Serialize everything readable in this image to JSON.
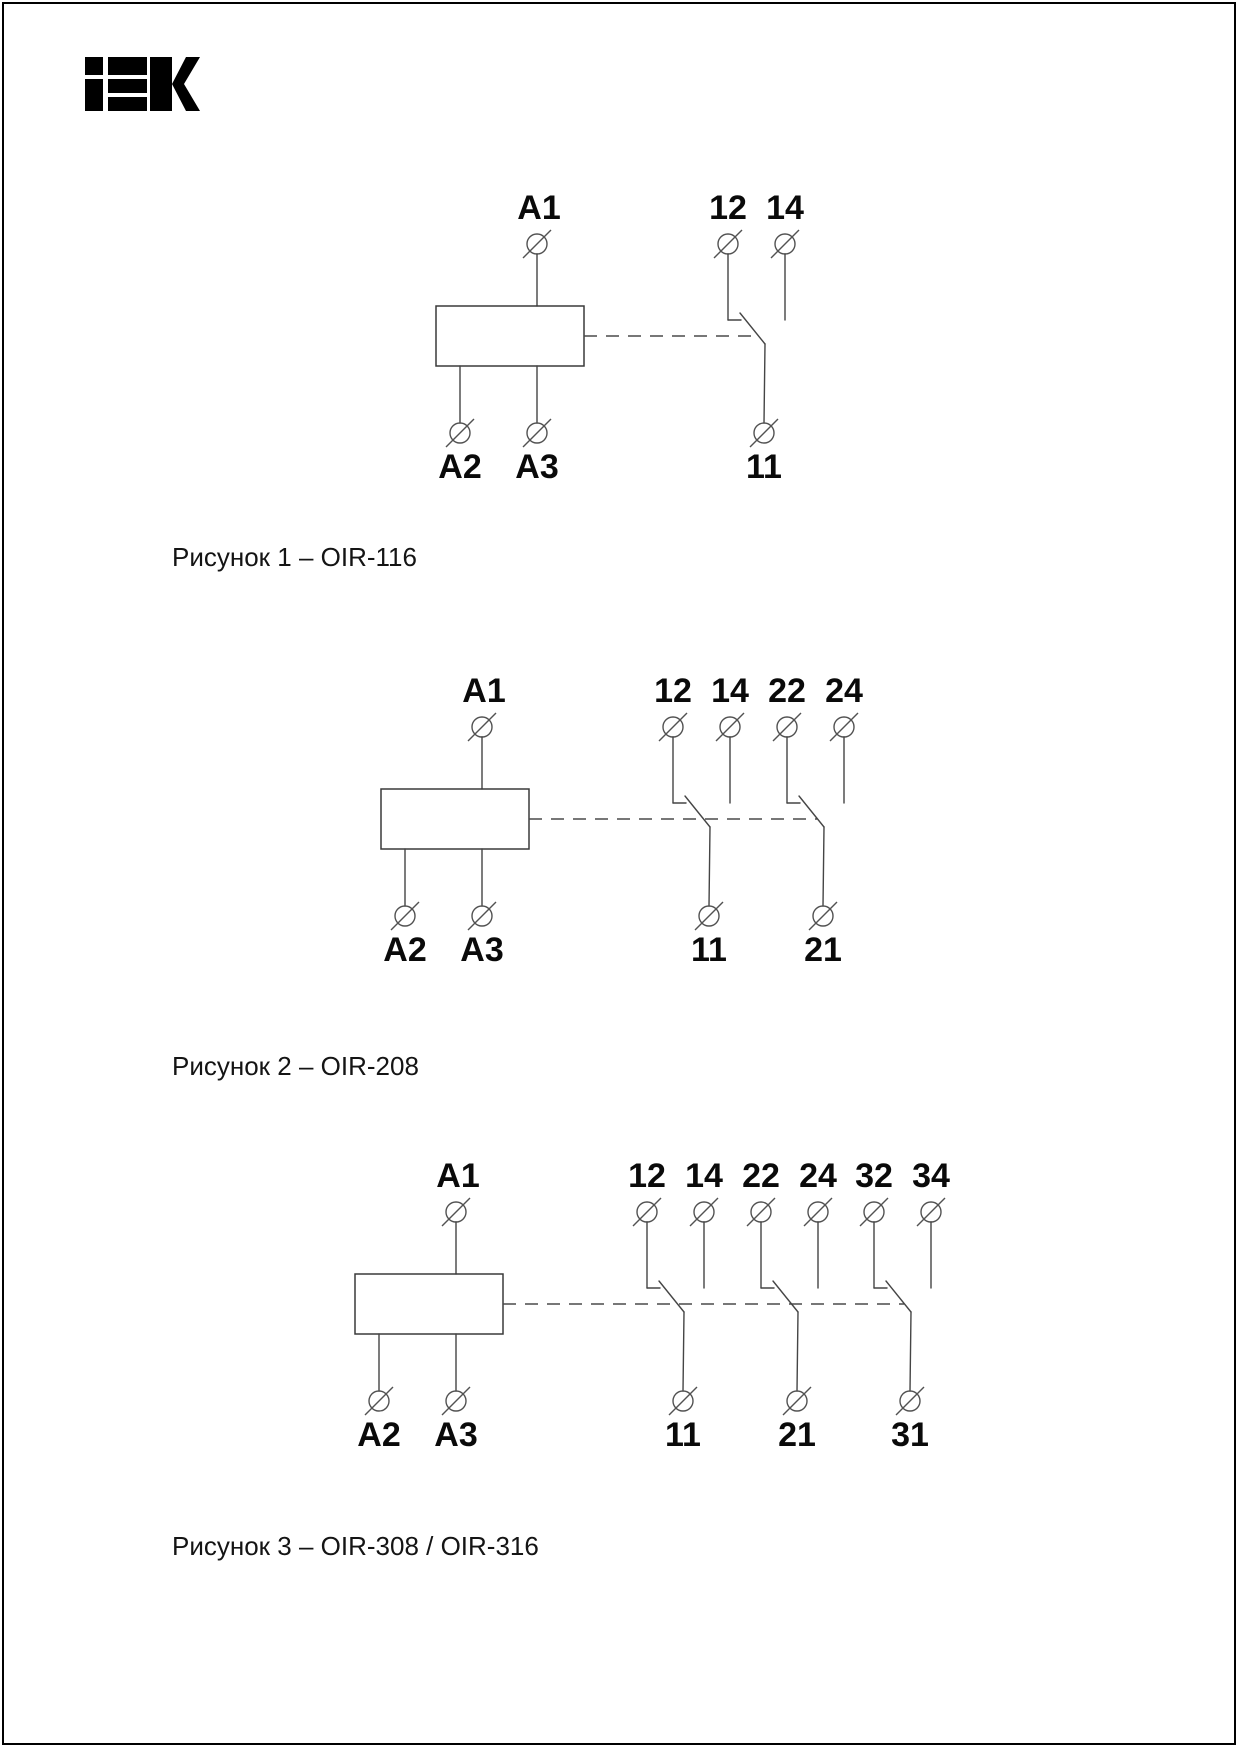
{
  "page": {
    "brand": "IEK",
    "background": "#ffffff",
    "ink": "#000000"
  },
  "figures": [
    {
      "caption": "Рисунок 1 – OIR-116",
      "coil": {
        "top_terminal": "A1",
        "bottom_terminals": [
          "A2",
          "A3"
        ]
      },
      "contact_groups": [
        {
          "nc": "12",
          "no": "14",
          "common": "11"
        }
      ]
    },
    {
      "caption": "Рисунок 2 – OIR-208",
      "coil": {
        "top_terminal": "A1",
        "bottom_terminals": [
          "A2",
          "A3"
        ]
      },
      "contact_groups": [
        {
          "nc": "12",
          "no": "14",
          "common": "11"
        },
        {
          "nc": "22",
          "no": "24",
          "common": "21"
        }
      ]
    },
    {
      "caption": "Рисунок 3 – OIR-308 / OIR-316",
      "coil": {
        "top_terminal": "A1",
        "bottom_terminals": [
          "A2",
          "A3"
        ]
      },
      "contact_groups": [
        {
          "nc": "12",
          "no": "14",
          "common": "11"
        },
        {
          "nc": "22",
          "no": "24",
          "common": "21"
        },
        {
          "nc": "32",
          "no": "34",
          "common": "31"
        }
      ]
    }
  ]
}
